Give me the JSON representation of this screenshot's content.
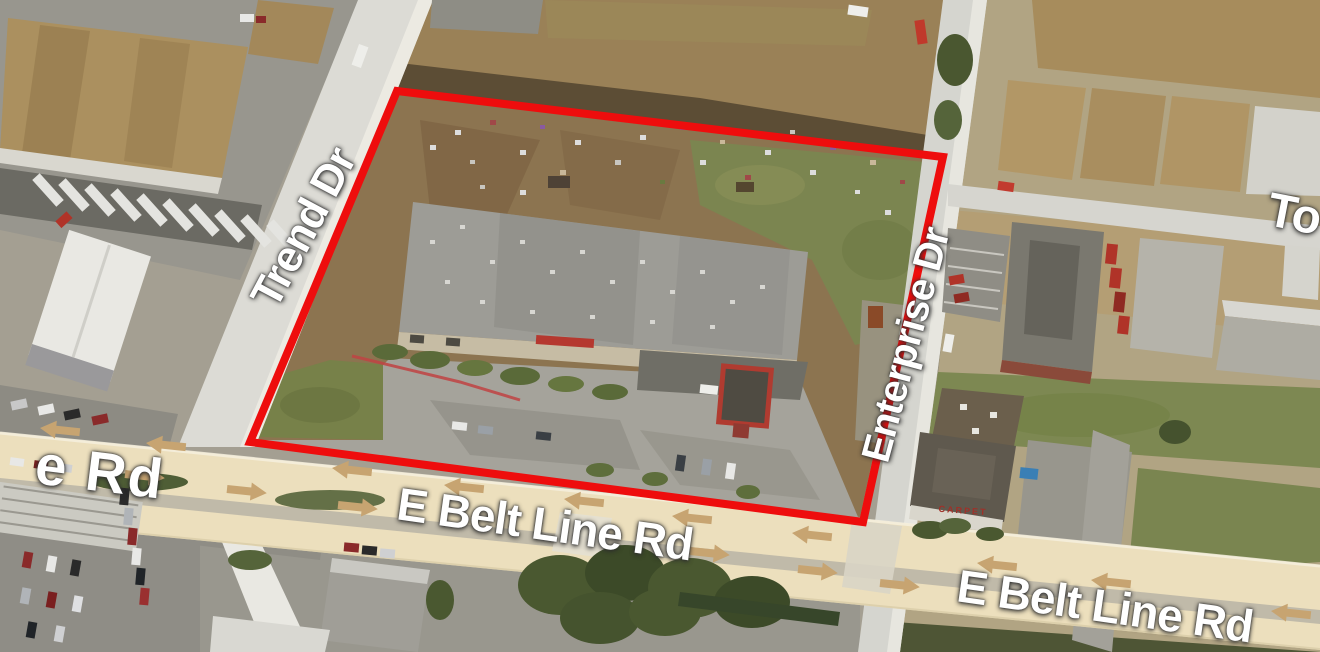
{
  "map": {
    "view": "aerial-birdseye",
    "labels": {
      "trend_dr": "Trend Dr",
      "enterprise_dr": "Enterprise Dr",
      "e_belt_line_rd_west": "E Belt Line Rd",
      "e_belt_line_rd_east": "E Belt Line Rd",
      "road_left_partial": "e Rd",
      "road_right_partial": "To",
      "building_sign": "CARPET"
    },
    "colors": {
      "property_boundary": "#EE0D0D",
      "highlighted_road": "#ECDFBD",
      "road_arrows": "#C7A471",
      "label_text": "#FFFFFF"
    },
    "icons": {
      "westbound_arrow": "left-arrow",
      "eastbound_arrow": "right-arrow"
    }
  }
}
